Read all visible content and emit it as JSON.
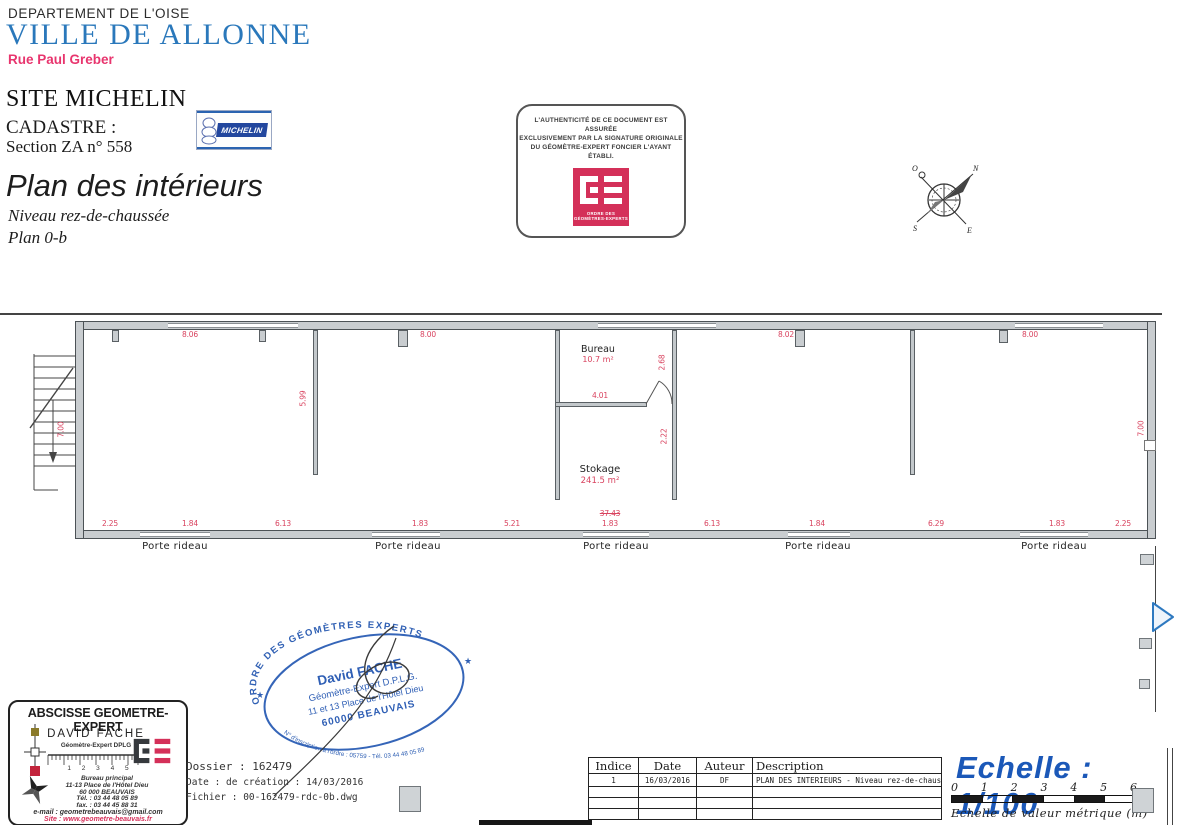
{
  "colors": {
    "heading_blue": "#2a78bb",
    "street_pink": "#e8356e",
    "dimension_red": "#d9435f",
    "stamp_blue": "#3060b4",
    "scale_blue": "#1b58b8",
    "oge_red": "#d43059",
    "wall_gray": "#c9cdd0"
  },
  "header": {
    "department": "DEPARTEMENT DE L'OISE",
    "city": "VILLE DE ALLONNE",
    "street": "Rue Paul Greber",
    "site": "SITE MICHELIN",
    "cadastre_label": "CADASTRE :",
    "cadastre_value": "Section ZA n° 558",
    "title": "Plan des intérieurs",
    "subtitle": "Niveau rez-de-chaussée",
    "plan_ref": "Plan 0-b",
    "michelin_logo": "MICHELIN"
  },
  "auth_box": {
    "line1": "L'AUTHENTICITÉ DE CE DOCUMENT EST ASSURÉE",
    "line2": "EXCLUSIVEMENT PAR LA SIGNATURE ORIGINALE",
    "line3": "DU GÉOMÈTRE-EXPERT FONCIER L'AYANT ÉTABLI.",
    "logo_line1": "ORDRE DES",
    "logo_line2": "GÉOMÈTRES-EXPERTS"
  },
  "compass": {
    "n": "N",
    "e": "E",
    "s": "S",
    "o": "O"
  },
  "plan": {
    "rooms": {
      "bureau": {
        "name": "Bureau",
        "area": "10.7 m²"
      },
      "stockage": {
        "name": "Stokage",
        "area": "241.5 m²"
      }
    },
    "porte_rideau": "Porte rideau",
    "dims": {
      "top": [
        "8.06",
        "8.00",
        "8.02",
        "8.00"
      ],
      "bottom": [
        "2.25",
        "1.84",
        "6.13",
        "1.83",
        "5.21",
        "1.83",
        "6.13",
        "1.84",
        "6.29",
        "1.83",
        "2.25"
      ],
      "bottom_total": "37.43",
      "left_height": "7.00",
      "right_height": "7.00",
      "wall_a": "5.99",
      "bureau_height": "2.68",
      "bureau_width": "4.01",
      "partition": "2.22"
    }
  },
  "stamp": {
    "arc_top": "ORDRE DES GÉOMÈTRES EXPERTS",
    "name": "David FACHE",
    "role": "Géomètre-Expert D.P.L.G.",
    "address1": "11 et 13 Place de l'Hôtel Dieu",
    "address2": "60000 BEAUVAIS",
    "arc_bottom": "N° d'inscription à l'ordre : 05759 - Tél. 03 44 48 05 89",
    "star": "★"
  },
  "abscisse": {
    "title": "ABSCISSE GEOMETRE-EXPERT",
    "name": "DAVID FACHE",
    "role": "Géomètre-Expert DPLG",
    "ruler_numbers": "1 2 3 4 5",
    "office": "Bureau principal",
    "address1": "11-13 Place de l'Hôtel Dieu",
    "address2": "60 000 BEAUVAIS",
    "tel": "Tél. : 03 44 48 05 89",
    "fax": "fax. : 03 44 45 88 31",
    "email": "e-mail : geometrebeauvais@gmail.com",
    "site": "Site : www.geometre-beauvais.fr"
  },
  "file_info": {
    "dossier": "Dossier : 162479",
    "created": "Date : de création : 14/03/2016",
    "file": "Fichier : 00-162479-rdc-0b.dwg"
  },
  "revisions": {
    "headers": [
      "Indice",
      "Date",
      "Auteur",
      "Description"
    ],
    "rows": [
      [
        "1",
        "16/03/2016",
        "DF",
        "PLAN DES INTERIEURS - Niveau rez-de-chaussée 0b"
      ]
    ]
  },
  "scale": {
    "title": "Echelle : 1/100",
    "ticks": [
      "0",
      "1",
      "2",
      "3",
      "4",
      "5",
      "6"
    ],
    "caption": "Echelle de valeur métrique (m)"
  }
}
